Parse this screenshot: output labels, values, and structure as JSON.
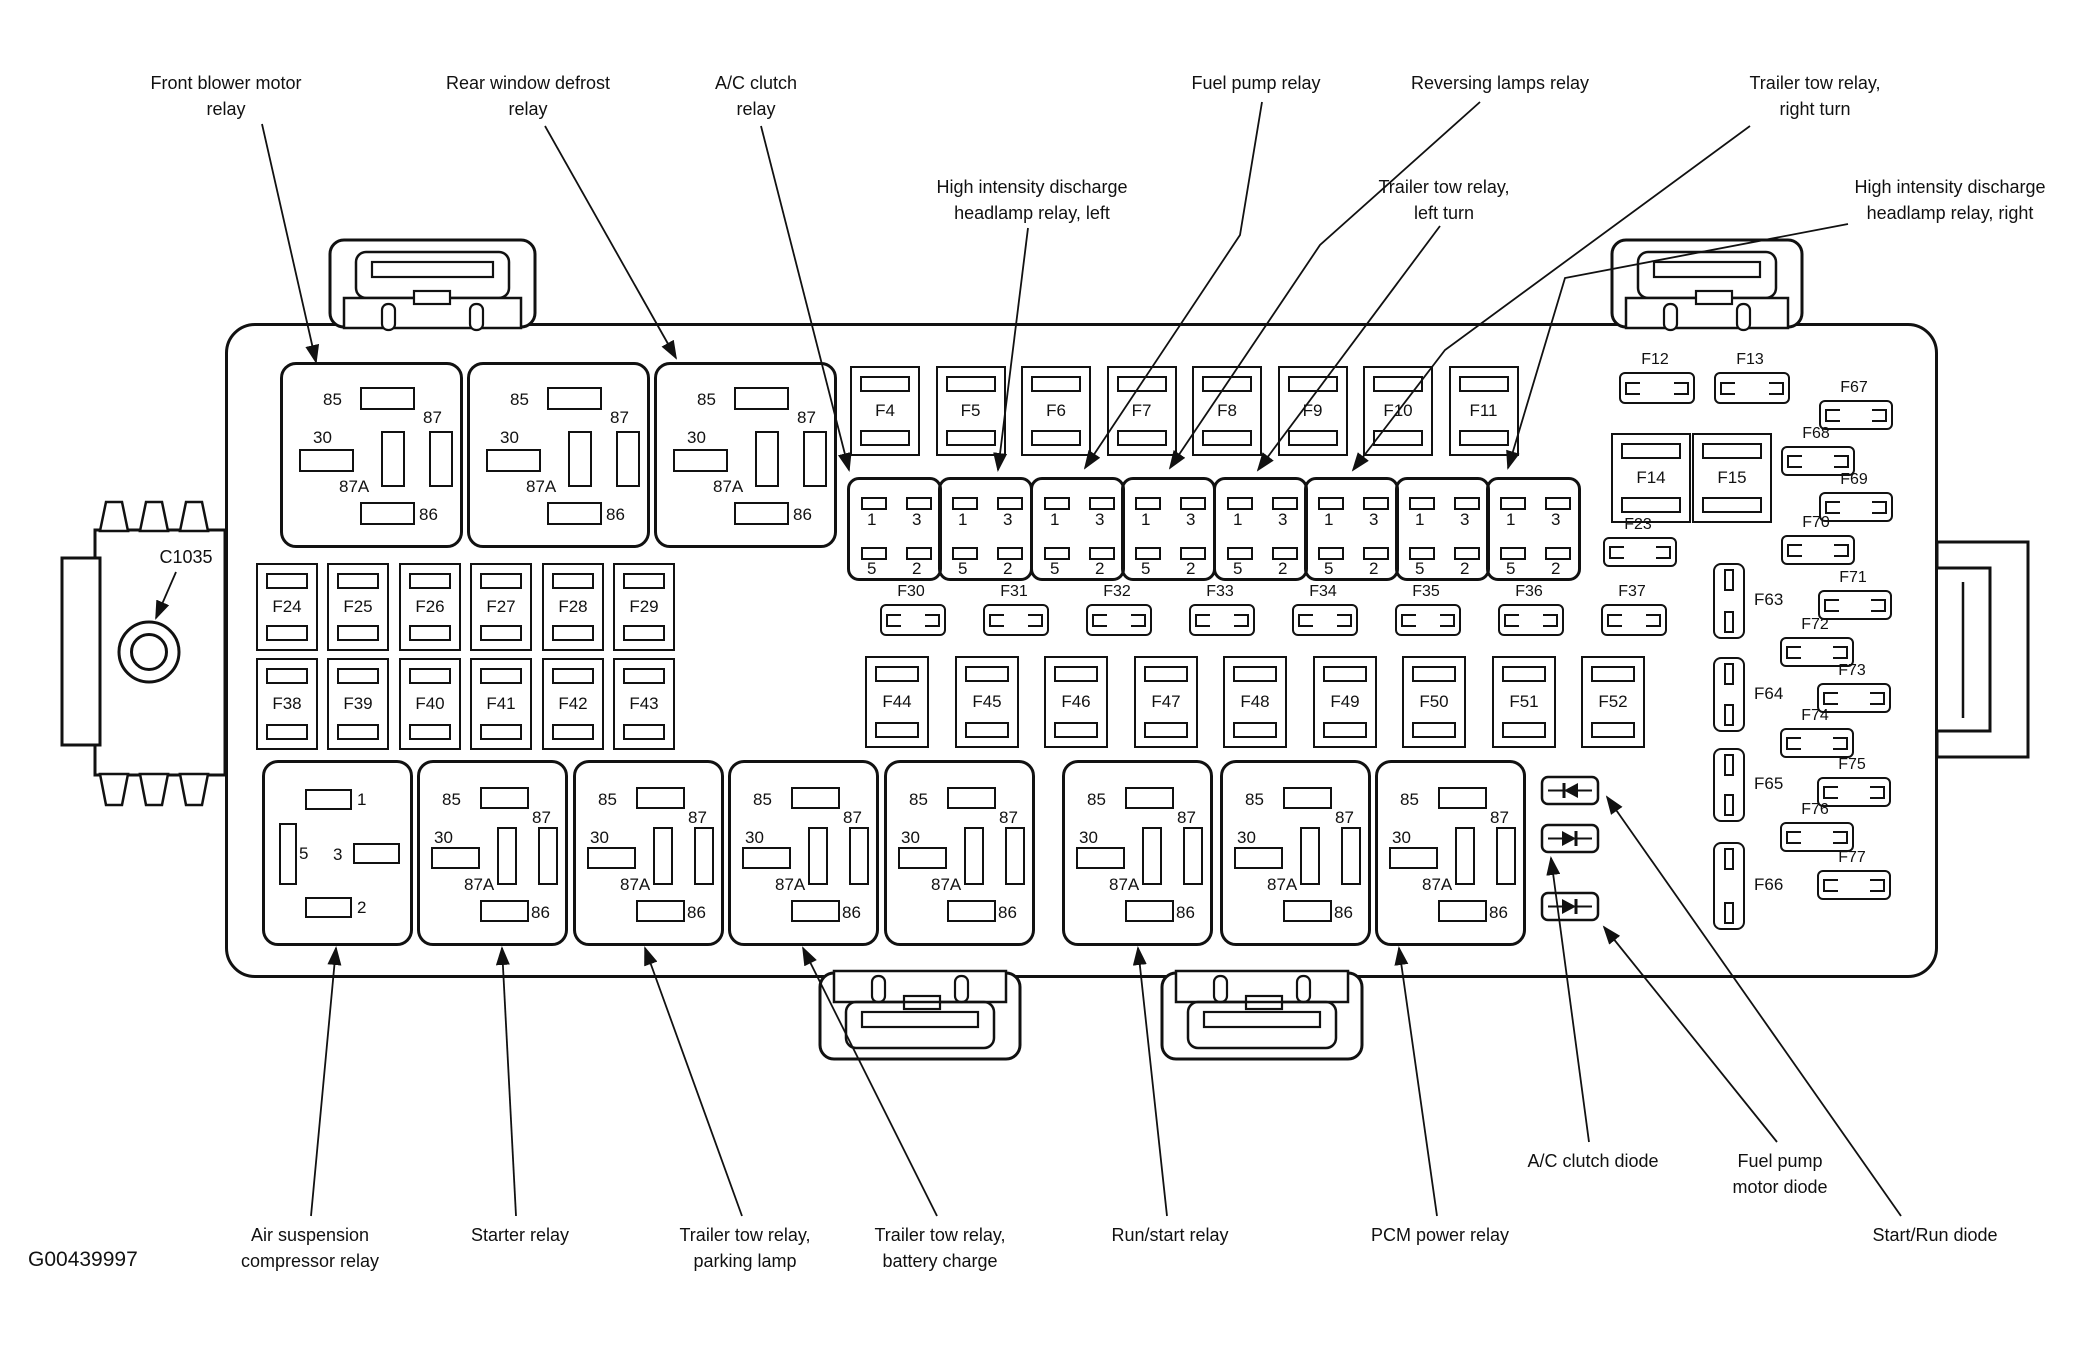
{
  "figure_id": "G00439997",
  "connector_label": "C1035",
  "pins": {
    "r5": [
      "85",
      "87",
      "30",
      "87A",
      "86"
    ],
    "r4": [
      "1",
      "3",
      "5",
      "2"
    ],
    "special": [
      "1",
      "5",
      "3",
      "2"
    ]
  },
  "fuses": {
    "top_row": [
      "F4",
      "F5",
      "F6",
      "F7",
      "F8",
      "F9",
      "F10",
      "F11"
    ],
    "pair": [
      "F12",
      "F13"
    ],
    "squares": [
      "F14",
      "F15"
    ],
    "f23": "F23",
    "row1": [
      "F24",
      "F25",
      "F26",
      "F27",
      "F28",
      "F29"
    ],
    "mini_row": [
      "F30",
      "F31",
      "F32",
      "F33",
      "F34",
      "F35",
      "F36",
      "F37"
    ],
    "row2": [
      "F38",
      "F39",
      "F40",
      "F41",
      "F42",
      "F43",
      "F44",
      "F45",
      "F46",
      "F47",
      "F48",
      "F49",
      "F50",
      "F51",
      "F52"
    ],
    "vertical": [
      "F63",
      "F64",
      "F65",
      "F66"
    ],
    "right_col": [
      "F67",
      "F68",
      "F69",
      "F70",
      "F71",
      "F72",
      "F73",
      "F74",
      "F75",
      "F76",
      "F77"
    ]
  },
  "callouts": {
    "top": [
      {
        "id": "front-blower-motor-relay",
        "lines": [
          "Front blower motor",
          "relay"
        ]
      },
      {
        "id": "rear-window-defrost-relay",
        "lines": [
          "Rear window defrost",
          "relay"
        ]
      },
      {
        "id": "ac-clutch-relay",
        "lines": [
          "A/C clutch",
          "relay"
        ]
      },
      {
        "id": "hid-headlamp-relay-left",
        "lines": [
          "High intensity discharge",
          "headlamp relay, left"
        ]
      },
      {
        "id": "fuel-pump-relay",
        "lines": [
          "Fuel pump relay"
        ]
      },
      {
        "id": "reversing-lamps-relay",
        "lines": [
          "Reversing lamps relay"
        ]
      },
      {
        "id": "trailer-tow-relay-left-turn",
        "lines": [
          "Trailer tow relay,",
          "left turn"
        ]
      },
      {
        "id": "trailer-tow-relay-right-turn",
        "lines": [
          "Trailer tow relay,",
          "right turn"
        ]
      },
      {
        "id": "hid-headlamp-relay-right",
        "lines": [
          "High intensity discharge",
          "headlamp relay, right"
        ]
      }
    ],
    "bottom": [
      {
        "id": "air-suspension-compressor-relay",
        "lines": [
          "Air suspension",
          "compressor relay"
        ]
      },
      {
        "id": "starter-relay",
        "lines": [
          "Starter relay"
        ]
      },
      {
        "id": "trailer-tow-relay-parking-lamp",
        "lines": [
          "Trailer tow relay,",
          "parking lamp"
        ]
      },
      {
        "id": "trailer-tow-relay-battery-charge",
        "lines": [
          "Trailer tow relay,",
          "battery charge"
        ]
      },
      {
        "id": "run-start-relay",
        "lines": [
          "Run/start relay"
        ]
      },
      {
        "id": "pcm-power-relay",
        "lines": [
          "PCM power relay"
        ]
      },
      {
        "id": "ac-clutch-diode",
        "lines": [
          "A/C clutch diode"
        ]
      },
      {
        "id": "fuel-pump-motor-diode",
        "lines": [
          "Fuel pump",
          "motor diode"
        ]
      },
      {
        "id": "start-run-diode",
        "lines": [
          "Start/Run diode"
        ]
      }
    ]
  }
}
